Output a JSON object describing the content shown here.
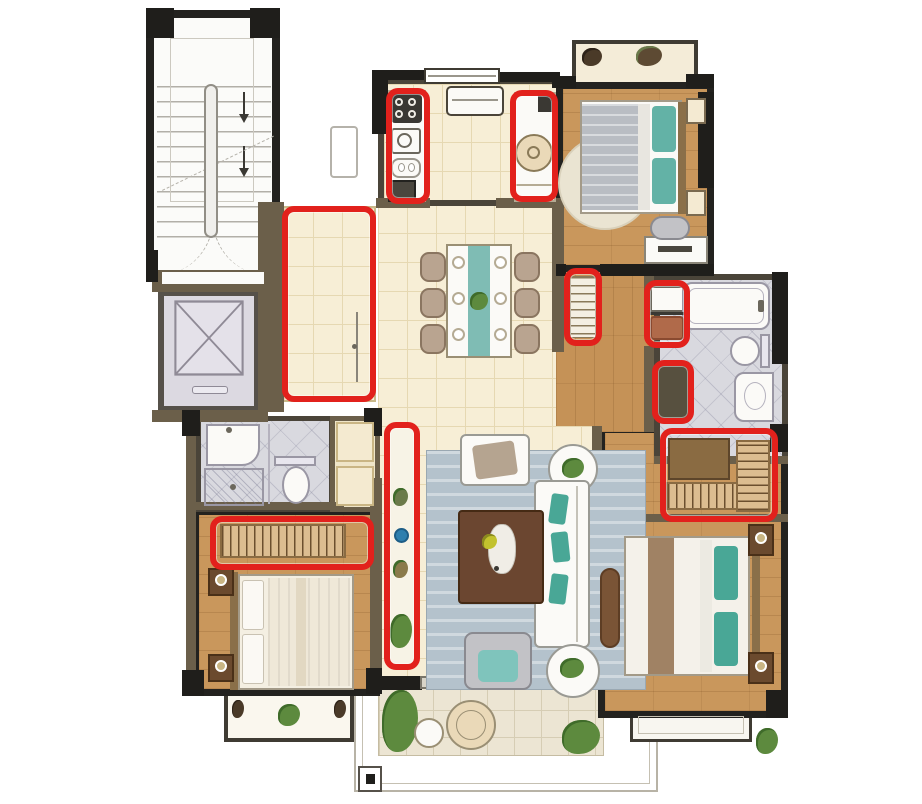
{
  "title": "apartment floor plan with red-highlighted storage locations",
  "colors": {
    "wall_dark": "#1f1e1b",
    "wall_brown": "#6b5f4a",
    "highlight_red": "#e2211c",
    "wood_floor": "#c9975c",
    "cream_tile": "#f7eed6",
    "gray_tile": "#d9d9df",
    "elevator_gray": "#dcd9e1",
    "teal_accent": "#49a796",
    "rug_blue_gray": "#b4c2cc",
    "plant_green": "#5d8a3e",
    "closet_tan": "#dcbd90"
  },
  "rooms": [
    {
      "id": "stairwell",
      "label": "communal stairwell with double-run stairs, down arrows and dashed door swings"
    },
    {
      "id": "elevator",
      "label": "elevator shaft marked with X"
    },
    {
      "id": "entry-foyer",
      "label": "entry foyer, red highlighted storage zone"
    },
    {
      "id": "kitchen",
      "label": "kitchen with window, hood, counters both sides"
    },
    {
      "id": "dining-room",
      "label": "dining room with six-seat table and teal runner"
    },
    {
      "id": "living-room",
      "label": "living room with sofa, armchair, coffee table, rug"
    },
    {
      "id": "hallway",
      "label": "interior hallway with storage cabinets"
    },
    {
      "id": "bedroom-north",
      "label": "north bedroom with gray bed, desk, chair and bay window"
    },
    {
      "id": "main-bathroom",
      "label": "main bathroom with bathtub, toilet and vanity"
    },
    {
      "id": "walk-in-closet",
      "label": "walk-in closet with L-shaped wardrobe, red highlighted"
    },
    {
      "id": "master-bedroom",
      "label": "master bedroom with teal-pillow bed, nightstands and bench"
    },
    {
      "id": "second-bedroom",
      "label": "south-west bedroom with wardrobe and bay window"
    },
    {
      "id": "second-bathroom",
      "label": "en-suite bathroom with shower, sink and toilet"
    },
    {
      "id": "closet-niche",
      "label": "closet niche beside en-suite bathroom"
    },
    {
      "id": "balcony",
      "label": "south balcony with plants and round tables"
    },
    {
      "id": "bay-window-south",
      "label": "bay window below second bedroom"
    },
    {
      "id": "bay-window-master",
      "label": "bay window below master bedroom"
    },
    {
      "id": "ac-platform",
      "label": "outdoor unit platform"
    }
  ],
  "annotations": {
    "style": "thick red rounded rectangle",
    "color": "#e2211c",
    "count": 9,
    "items": [
      {
        "id": "kitchen-counter-left",
        "label": "kitchen counter with cooktop and sink"
      },
      {
        "id": "kitchen-counter-right",
        "label": "kitchen counter with washing machine"
      },
      {
        "id": "entry-foyer-zone",
        "label": "entry foyer storage area with door"
      },
      {
        "id": "hallway-slatted-cabinet",
        "label": "slatted shoe cabinet"
      },
      {
        "id": "hallway-cabinet-upper",
        "label": "hallway storage cabinet"
      },
      {
        "id": "hallway-cabinet-lower",
        "label": "hallway storage niche"
      },
      {
        "id": "walk-in-closet-box",
        "label": "L-shaped wardrobe with hanging clothes"
      },
      {
        "id": "living-display-shelf",
        "label": "tall display shelf with plants and blue bowl"
      },
      {
        "id": "bedroom-wardrobe",
        "label": "wardrobe with hanging rail"
      }
    ]
  },
  "furniture": {
    "stairwell": [
      "stairs",
      "center rail",
      "two down arrows",
      "double swing doors"
    ],
    "kitchen": [
      "cooktop",
      "sink",
      "counter",
      "washing machine",
      "range hood"
    ],
    "dining-room": [
      "table with teal runner",
      "6 chairs",
      "6 plates",
      "center plant"
    ],
    "living-room": [
      "armchair",
      "two-seat sofa with teal cushions",
      "lounge chair",
      "dark coffee table with sculpture",
      "two round side tables",
      "blue-gray rug",
      "display shelf"
    ],
    "bedroom-north": [
      "double bed gray blanket teal pillow",
      "round rug",
      "two nightstands",
      "desk with monitor",
      "desk chair",
      "bay window plants"
    ],
    "main-bathroom": [
      "bathtub",
      "toilet",
      "vanity with basin"
    ],
    "walk-in-closet": [
      "corner cabinet",
      "hanging rails"
    ],
    "master-bedroom": [
      "double bed with teal pillows",
      "two nightstands with lamps",
      "bench",
      "bay window"
    ],
    "second-bedroom": [
      "double bed",
      "two nightstands with lamps",
      "wardrobe",
      "bay window with plant"
    ],
    "second-bathroom": [
      "sink",
      "shower",
      "toilet"
    ],
    "balcony": [
      "two planters",
      "round table set",
      "sliding door",
      "railing"
    ]
  }
}
